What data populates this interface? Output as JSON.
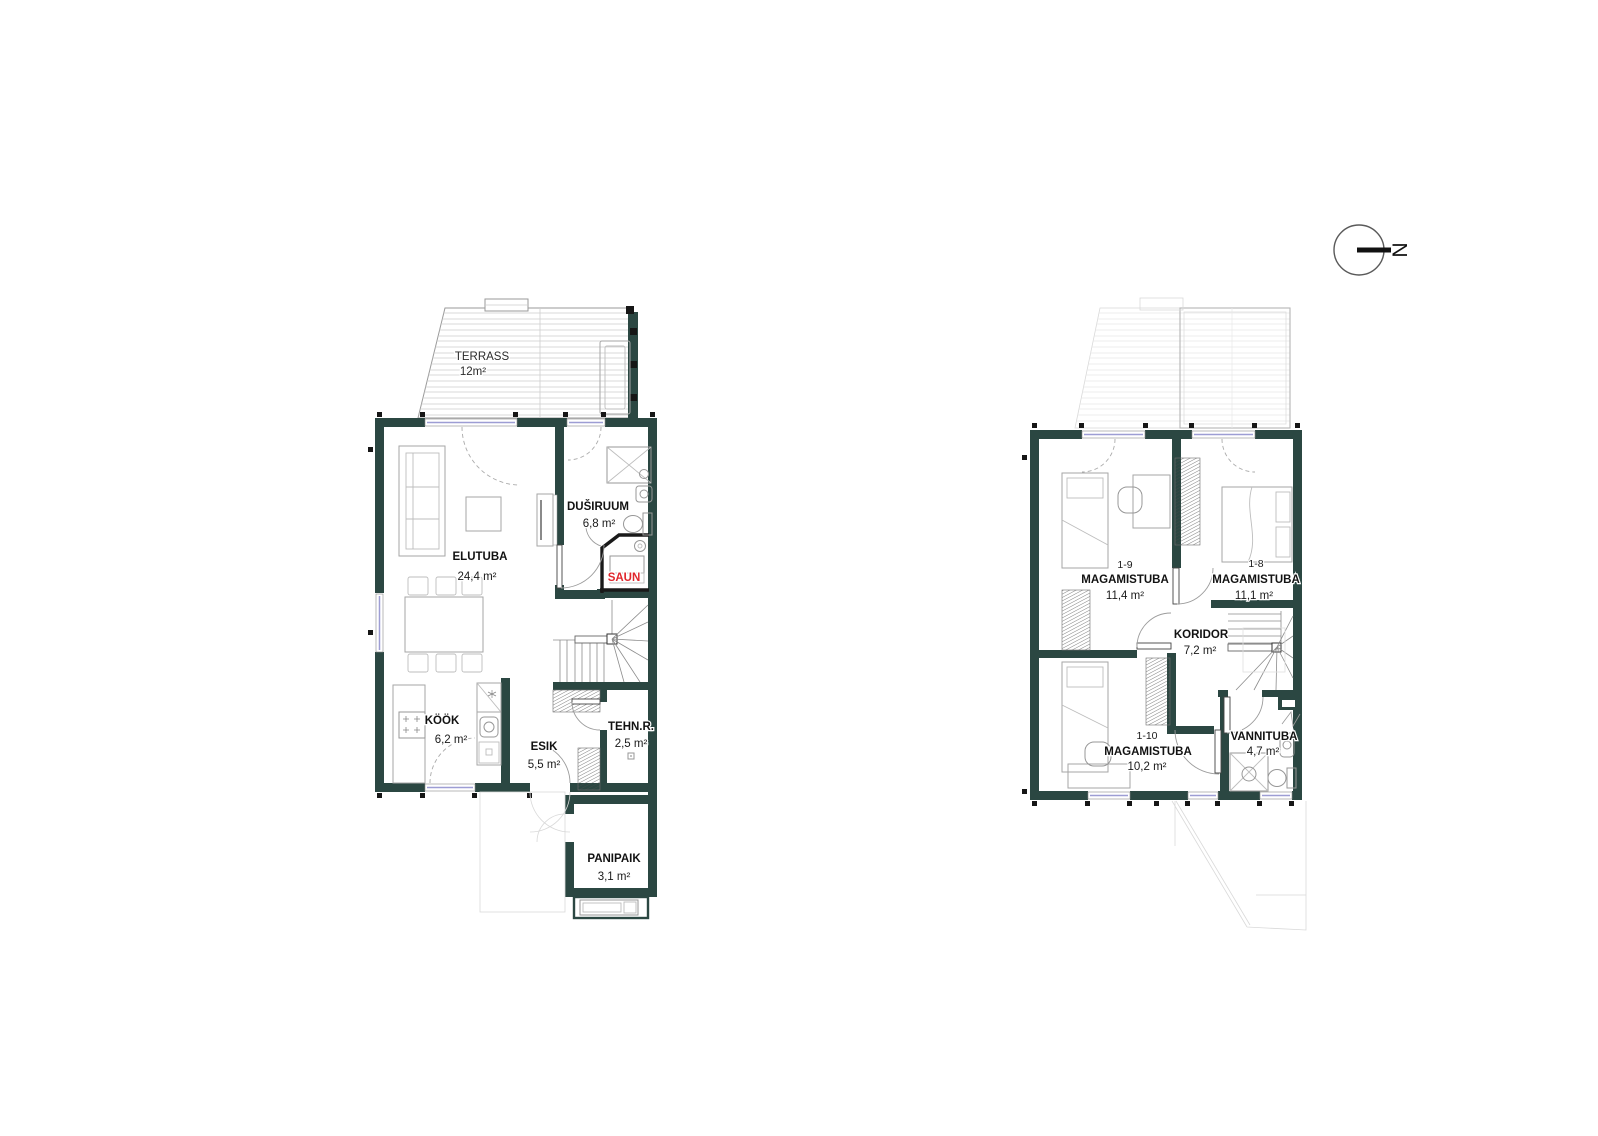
{
  "colors": {
    "wall": "#2b4742",
    "sauna_label": "#e0262c",
    "window": "#9d9dd4",
    "background": "#ffffff"
  },
  "north": {
    "letter": "N"
  },
  "floor1": {
    "terrass": {
      "name": "TERRASS",
      "area": "12m²"
    },
    "elutuba": {
      "name": "ELUTUBA",
      "area": "24,4 m²"
    },
    "dusiruum": {
      "name": "DUŠIRUUM",
      "area": "6,8 m²"
    },
    "saun": {
      "name": "SAUN"
    },
    "kook": {
      "name": "KÖÖK",
      "area": "6,2 m²"
    },
    "esik": {
      "name": "ESIK",
      "area": "5,5 m²"
    },
    "tehnr": {
      "name": "TEHN.R.",
      "area": "2,5 m²"
    },
    "panipaik": {
      "name": "PANIPAIK",
      "area": "3,1 m²"
    }
  },
  "floor2": {
    "mag9": {
      "code": "1-9",
      "name": "MAGAMISTUBA",
      "area": "11,4 m²"
    },
    "mag8": {
      "code": "1-8",
      "name": "MAGAMISTUBA",
      "area": "11,1 m²"
    },
    "koridor": {
      "name": "KORIDOR",
      "area": "7,2 m²"
    },
    "mag10": {
      "code": "1-10",
      "name": "MAGAMISTUBA",
      "area": "10,2 m²"
    },
    "vannituba": {
      "name": "VANNITUBA",
      "area": "4,7 m²"
    }
  }
}
